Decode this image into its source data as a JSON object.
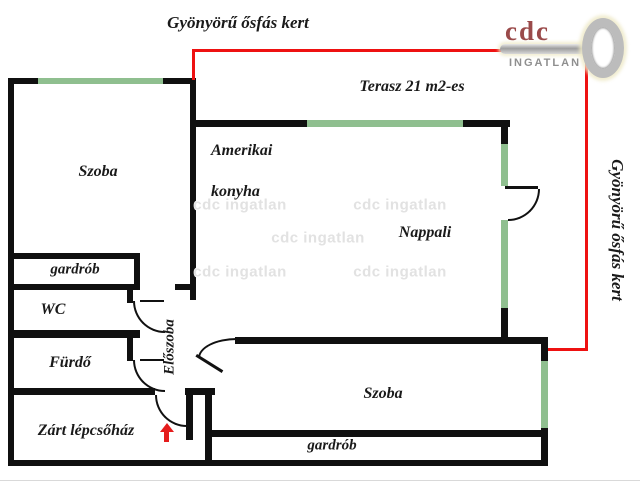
{
  "titles": {
    "top_garden": "Gyönyörű ősfás kert",
    "right_garden": "Gyönyörű ősfás kert",
    "terrace": "Terasz 21 m2-es"
  },
  "rooms": {
    "szoba_top": "Szoba",
    "kitchen_line1": "Amerikai",
    "kitchen_line2": "konyha",
    "nappali": "Nappali",
    "gardrob_left": "gardrób",
    "wc": "WC",
    "furdo": "Fürdő",
    "eloszoba": "Előszoba",
    "stairwell": "Zárt lépcsőház",
    "szoba_bottom": "Szoba",
    "gardrob_bottom": "gardrób"
  },
  "watermark": {
    "text": "cdc ingatlan"
  },
  "logo": {
    "brand": "cdc",
    "subtitle": "INGATLAN"
  },
  "colors": {
    "wall": "#101010",
    "window_green": "#8fbf8f",
    "terrace_red": "#ee1111",
    "arrow_red": "#e51c1c",
    "logo_maroon": "#9a4a4a",
    "logo_gray": "#8f8f8f",
    "watermark_gray": "#e2e2e2",
    "label_text": "#1a1a1a"
  }
}
